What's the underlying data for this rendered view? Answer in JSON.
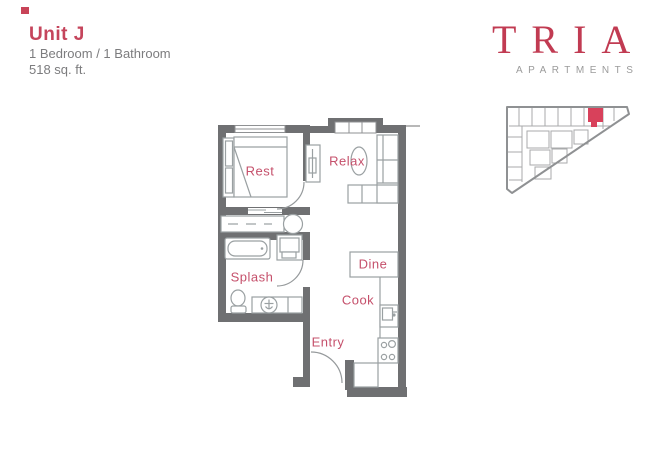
{
  "header": {
    "unit_title": "Unit J",
    "specs": "1 Bedroom / 1 Bathroom",
    "area": "518 sq. ft."
  },
  "brand": {
    "name": "TRIA",
    "subtitle": "APARTMENTS"
  },
  "floor_plan": {
    "labels": {
      "bedroom": "Rest",
      "living": "Relax",
      "bathroom": "Splash",
      "dining": "Dine",
      "kitchen": "Cook",
      "entry": "Entry"
    }
  },
  "colors": {
    "accent_red": "#c5455c",
    "room_label_red": "#c5506b",
    "unit_marker_red": "#d8415b",
    "wall_gray": "#6f7072",
    "furniture_gray": "#9aa0a2",
    "text_gray": "#7c7c7e",
    "logo_red": "#c13b52",
    "logo_gray": "#9b9b9b",
    "site_outline_gray": "#8f9193"
  }
}
